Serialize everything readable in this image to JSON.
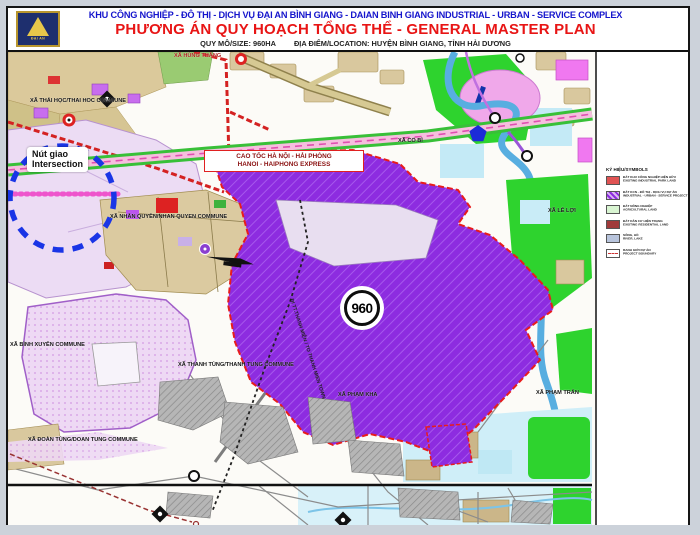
{
  "header": {
    "logo_label": "ĐẠI AN",
    "title_vi": "KHU CÔNG NGHIỆP - ĐÔ THỊ - DỊCH VỤ ĐẠI AN BÌNH GIANG - DAIAN BINH GIANG INDUSTRIAL - URBAN - SERVICE COMPLEX",
    "title_en": "PHƯƠNG ÁN QUY HOẠCH TỔNG THỂ - GENERAL MASTER PLAN",
    "size_label": "QUY MÔ/SIZE: 960HA",
    "location_label": "ĐỊA ĐIỂM/LOCATION: HUYỆN BÌNH GIANG, TỈNH HẢI DƯƠNG"
  },
  "map": {
    "area_badge": "960",
    "intersection_vi": "Nút giao",
    "intersection_en": "Intersection",
    "expressway_vi": "CAO TỐC HÀ NỘI - HẢI PHÒNG",
    "expressway_en": "HANOI - HAIPHONG EXPRESS",
    "thanh_mien_road": "ĐI TT.THANH MIỆN / TO THANH MIEN TOWN",
    "communes": [
      {
        "label": "XÃ THÁI HỌC/THAI HOC COMMUNE"
      },
      {
        "label": "XÃ HÙNG THẮNG"
      },
      {
        "label": "XÃ CỔ BÌ"
      },
      {
        "label": "XÃ LÊ LỢI"
      },
      {
        "label": "XÃ NHÂN QUYỀN/NHAN QUYEN COMMUNE"
      },
      {
        "label": "XÃ BÌNH XUYÊN COMMUNE"
      },
      {
        "label": "XÃ THANH TÙNG/THANH TUNG COMMUNE"
      },
      {
        "label": "XÃ ĐOÀN TÙNG/DOAN TUNG COMMUNE"
      },
      {
        "label": "XÃ PHẠM KHA"
      },
      {
        "label": "XÃ PHẠM TRẤN"
      }
    ]
  },
  "legend": {
    "title": "KÝ HIỆU/SYMBOLS",
    "items": [
      {
        "vi": "ĐẤT KHU CÔNG NGHIỆP HIỆN HỮU",
        "en": "EXISTING INDUSTRIAL PARK LAND"
      },
      {
        "vi": "ĐẤT KCN - ĐÔ THỊ - DỊCH VỤ DỰ ÁN",
        "en": "INDUSTRIAL - URBAN - SERVICE PROJECT"
      },
      {
        "vi": "ĐẤT NÔNG NGHIỆP",
        "en": "AGRICULTURAL LAND"
      },
      {
        "vi": "ĐẤT DÂN CƯ HIỆN TRẠNG",
        "en": "EXISTING RESIDENTIAL LAND"
      },
      {
        "vi": "SÔNG, HỒ",
        "en": "RIVER, LAKE"
      },
      {
        "vi": "RANH GIỚI DỰ ÁN",
        "en": "PROJECT BOUNDARY"
      }
    ]
  },
  "colors": {
    "title_blue": "#1515cc",
    "title_red": "#e81515",
    "site_purple": "#8d2ce0",
    "boundary_red": "#e81c1c",
    "intersection_blue": "#1a35e6",
    "water_blue": "#58aee0",
    "field_green": "#2ed32e"
  }
}
